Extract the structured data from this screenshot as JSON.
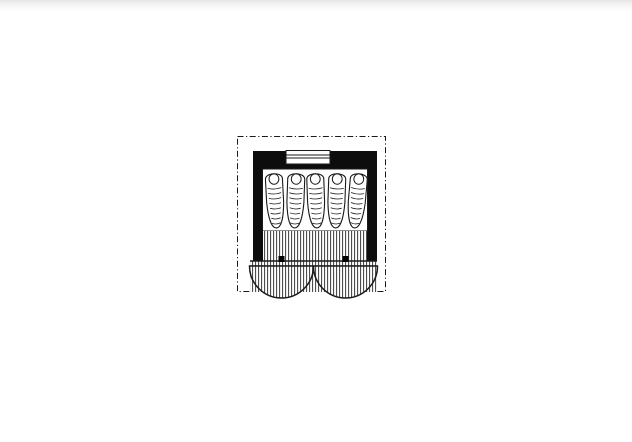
{
  "canvas": {
    "width": 632,
    "height": 442,
    "background": "#ffffff",
    "top_strip_color": "#e6e6e6"
  },
  "drawing": {
    "title": "cabin-sleeping-hut-floor-plan",
    "ink": "#1a1a1a",
    "roof_outline": {
      "x": 237.5,
      "y": 136.5,
      "width": 148,
      "height": 155,
      "dash": "6 2.5 1.2 2.5"
    },
    "walls": {
      "x": 253,
      "y": 151,
      "width": 124,
      "height": 110,
      "fill": "#0d0d0d"
    },
    "window": {
      "x": 286,
      "y": 150.5,
      "width": 44,
      "height": 13.5,
      "mullion_offsets": [
        4.5,
        7.5
      ]
    },
    "platform": {
      "x": 262.5,
      "y": 169,
      "width": 105,
      "height": 62,
      "fill": "#ffffff"
    },
    "sleeping_bags": {
      "count": 5,
      "width": 19,
      "height": 57,
      "top": 171,
      "centers_x": [
        275,
        295.5,
        316,
        336.5,
        357
      ],
      "tilts_deg": [
        -3,
        2,
        -2,
        2,
        5
      ],
      "ripple_lines": 8
    },
    "interior_floor": {
      "x": 263,
      "y": 231,
      "width": 104,
      "height": 30
    },
    "threshold": {
      "x": 250,
      "y": 261,
      "width": 127,
      "height": 5
    },
    "porch": {
      "x": 250,
      "y": 266,
      "width": 127,
      "height": 26
    },
    "doors": {
      "count": 2,
      "radius": 32,
      "pivots_x": [
        281.5,
        345.5
      ],
      "pivot_y": 266,
      "hinge_size": 6,
      "hinge_y": 256
    },
    "hatch": {
      "spacing": 3,
      "line_width": 1,
      "color": "#3a3a3a",
      "bg": "#f2f2f2"
    }
  }
}
